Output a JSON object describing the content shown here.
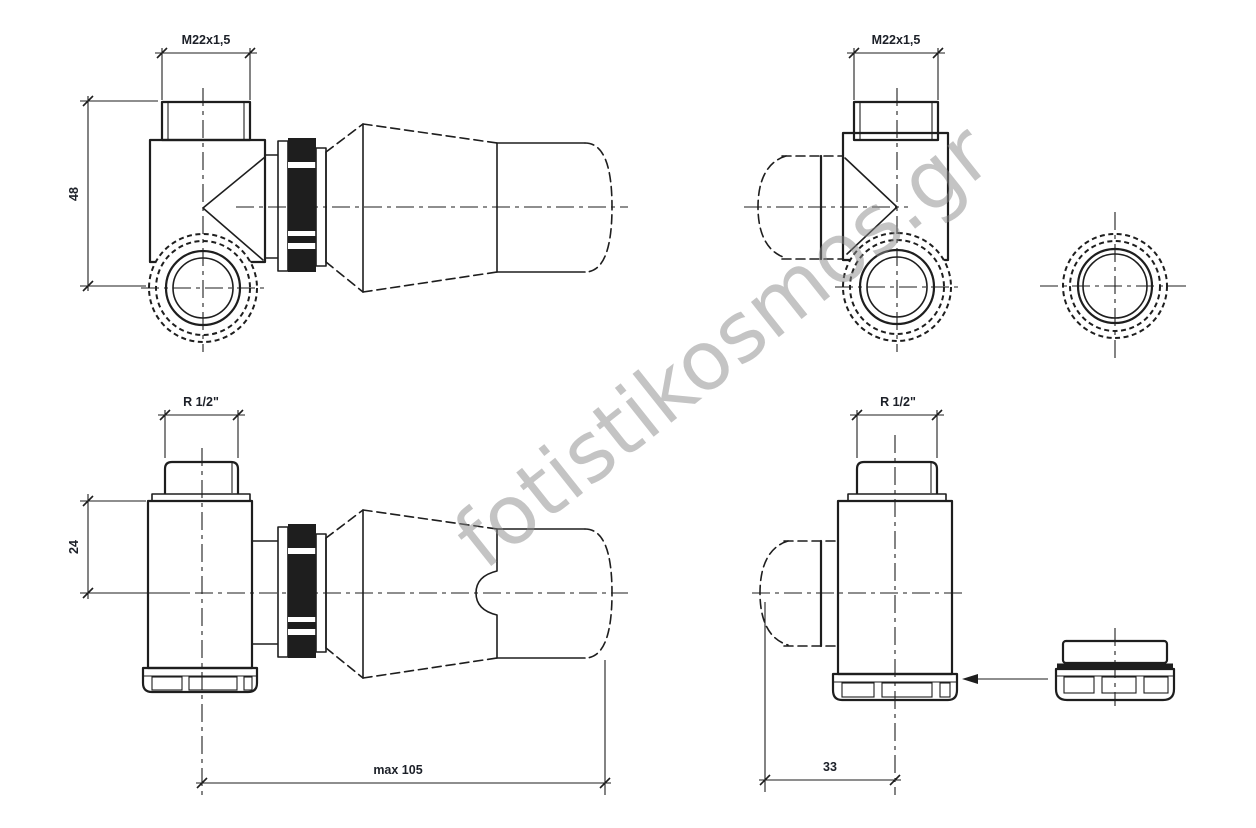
{
  "colors": {
    "line": "#1e1e1e",
    "dimtext": "#1c2028",
    "watermark": "#8a8a8a"
  },
  "watermark": {
    "text": "fotistikosmos.gr"
  },
  "dims": {
    "m22_left": "M22x1,5",
    "m22_right": "M22x1,5",
    "h48": "48",
    "r12_left": "R 1/2\"",
    "r12_right": "R 1/2\"",
    "h24": "24",
    "max105": "max 105",
    "w33": "33"
  }
}
